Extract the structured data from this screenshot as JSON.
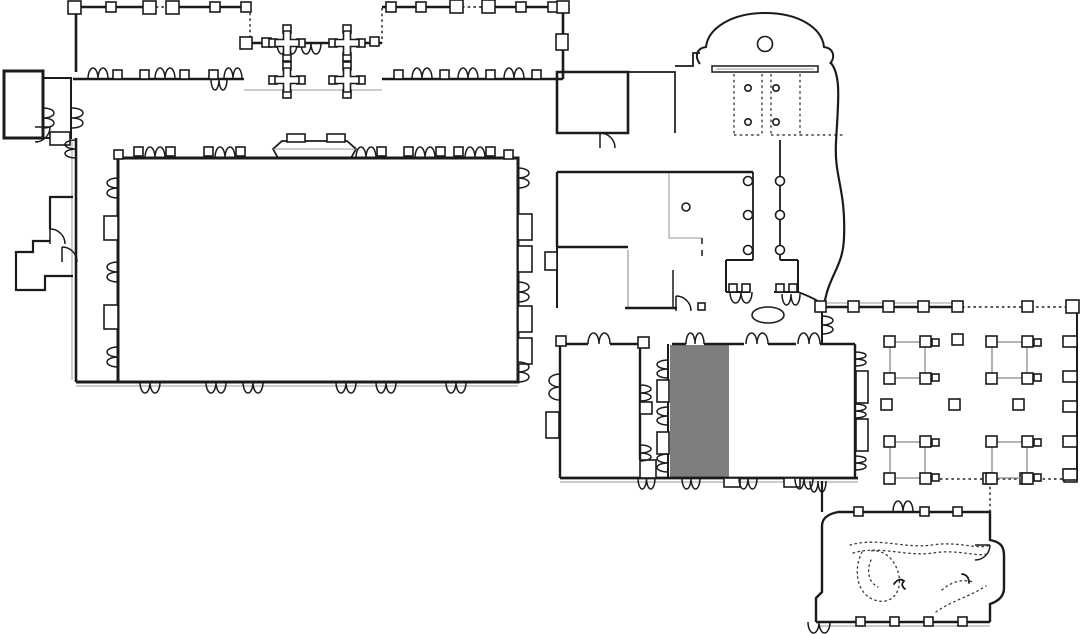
{
  "document": {
    "title": "Building floor plan",
    "background": "#ffffff"
  },
  "colors": {
    "background": "#ffffff",
    "wall": "#1b1b1b",
    "wall_light": "#9b9b9b",
    "highlight_room": "#7e7e7e",
    "courtyard_outline": "#8a8a8a",
    "garden_dots": "#3a3a3a"
  },
  "plan": {
    "type": "building-floor-plan",
    "highlighted_room": "south-hall-west-bay",
    "rooms": [
      {
        "name": "north-range-west",
        "highlighted": false
      },
      {
        "name": "narthex-center",
        "highlighted": false
      },
      {
        "name": "north-range-east",
        "highlighted": false
      },
      {
        "name": "west-annex",
        "highlighted": false
      },
      {
        "name": "northwest-annex",
        "highlighted": false
      },
      {
        "name": "great-hall",
        "highlighted": false
      },
      {
        "name": "west-aisle",
        "highlighted": false
      },
      {
        "name": "east-corridor",
        "highlighted": false
      },
      {
        "name": "north-rooms",
        "highlighted": false
      },
      {
        "name": "apse-rotunda",
        "highlighted": false
      },
      {
        "name": "north-terrace",
        "highlighted": false
      },
      {
        "name": "crossing-hall",
        "highlighted": false
      },
      {
        "name": "vestibule",
        "highlighted": false
      },
      {
        "name": "south-hall-west-bay",
        "highlighted": true
      },
      {
        "name": "south-hall-east",
        "highlighted": false
      },
      {
        "name": "south-corridor",
        "highlighted": false
      },
      {
        "name": "cloister-court",
        "highlighted": false
      },
      {
        "name": "south-terrace",
        "highlighted": false
      },
      {
        "name": "garden-room",
        "highlighted": false
      }
    ],
    "features": [
      "double-door-swings",
      "single-door-swings",
      "wall-pilasters",
      "cruciform-piers",
      "round-columns",
      "courtyard-column-grids",
      "rotunda-circle",
      "oval-table",
      "dotted-garden-paths",
      "stage-platform"
    ]
  }
}
